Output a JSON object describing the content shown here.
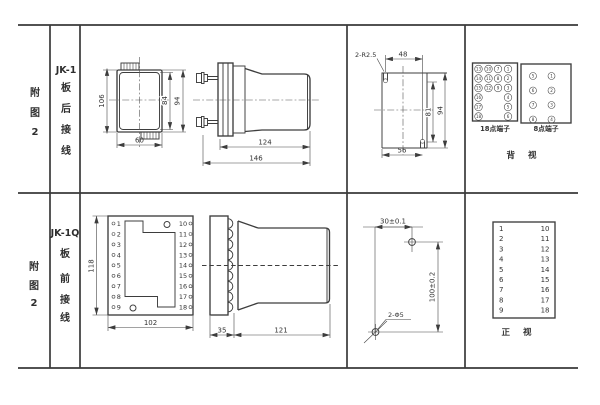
{
  "colors": {
    "line": "#3d3d3d",
    "text": "#333333",
    "background": "#ffffff"
  },
  "row1": {
    "fig": [
      "附",
      "图",
      "2"
    ],
    "model": "JK-1",
    "wiring": [
      "板",
      "后",
      "接",
      "线"
    ],
    "front": {
      "h106": "106",
      "h84": "84",
      "h94": "94",
      "w60": "60"
    },
    "side": {
      "d124": "124",
      "d146": "146"
    },
    "cutout": {
      "note": "2-R2.5",
      "d48": "48",
      "d81": "81",
      "d94": "94",
      "d56": "56"
    },
    "t18": {
      "label": "18点端子",
      "c1": [
        "13",
        "14",
        "15",
        "16",
        "17",
        "18"
      ],
      "c2": [
        "10",
        "11",
        "12"
      ],
      "c3": [
        "7",
        "8",
        "9"
      ],
      "c4": [
        "1",
        "2",
        "3",
        "4",
        "5",
        "6"
      ]
    },
    "t8": {
      "label": "8点端子",
      "left": [
        "5",
        "6",
        "7",
        "8"
      ],
      "right": [
        "1",
        "2",
        "3",
        "4"
      ]
    },
    "view": "背 视"
  },
  "row2": {
    "fig": [
      "附",
      "图",
      "2"
    ],
    "model": "JK-1Q",
    "wiring": [
      "板",
      "前",
      "接",
      "线"
    ],
    "front": {
      "h118": "118",
      "w102": "102",
      "left": [
        "1",
        "2",
        "3",
        "4",
        "5",
        "6",
        "7",
        "8",
        "9"
      ],
      "right": [
        "10",
        "11",
        "12",
        "13",
        "14",
        "15",
        "16",
        "17",
        "18"
      ]
    },
    "side": {
      "d35": "35",
      "d121": "121"
    },
    "drill": {
      "dh": "30±0.1",
      "dv": "100±0.2",
      "note": "2-Φ5"
    },
    "table": {
      "left": [
        "1",
        "2",
        "3",
        "4",
        "5",
        "6",
        "7",
        "8",
        "9"
      ],
      "right": [
        "10",
        "11",
        "12",
        "13",
        "14",
        "15",
        "16",
        "17",
        "18"
      ]
    },
    "view": "正 视"
  }
}
